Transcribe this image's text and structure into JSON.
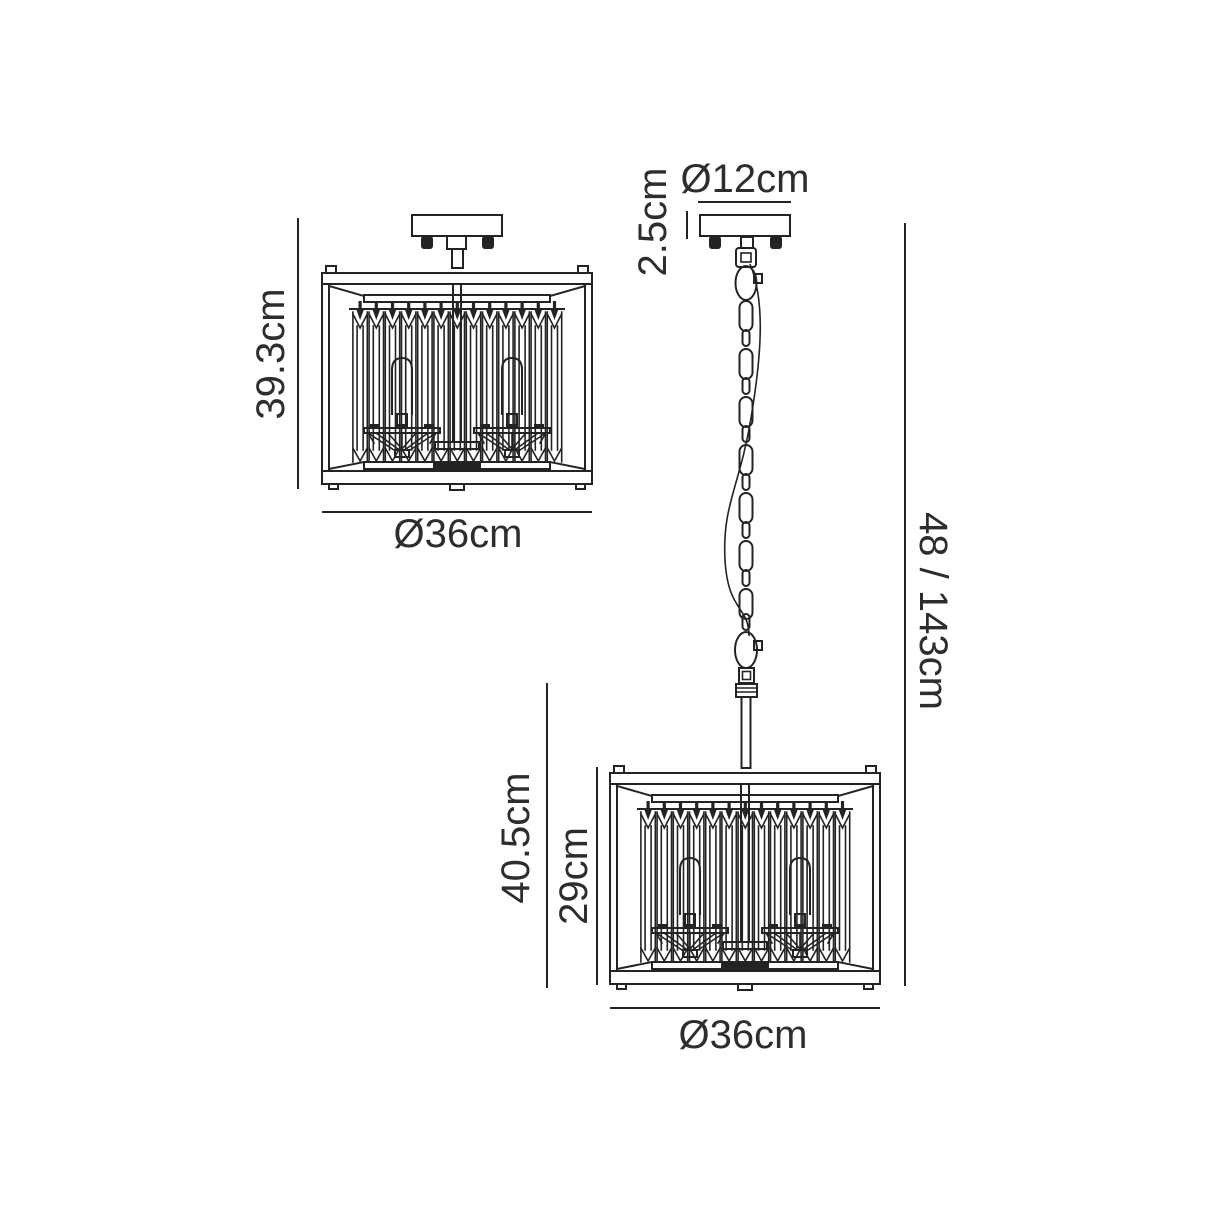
{
  "diagram": {
    "colors": {
      "line": "#232323",
      "text": "#2d2d2d",
      "background": "#ffffff"
    },
    "semi_flush_view": {
      "height_label": "39.3cm",
      "diameter_label": "Ø36cm"
    },
    "pendant_view": {
      "canopy_diameter_label": "Ø12cm",
      "canopy_height_label": "2.5cm",
      "drop_height_label": "48 / 143cm",
      "body_height_label": "40.5cm",
      "shade_height_label": "29cm",
      "diameter_label": "Ø36cm"
    }
  }
}
